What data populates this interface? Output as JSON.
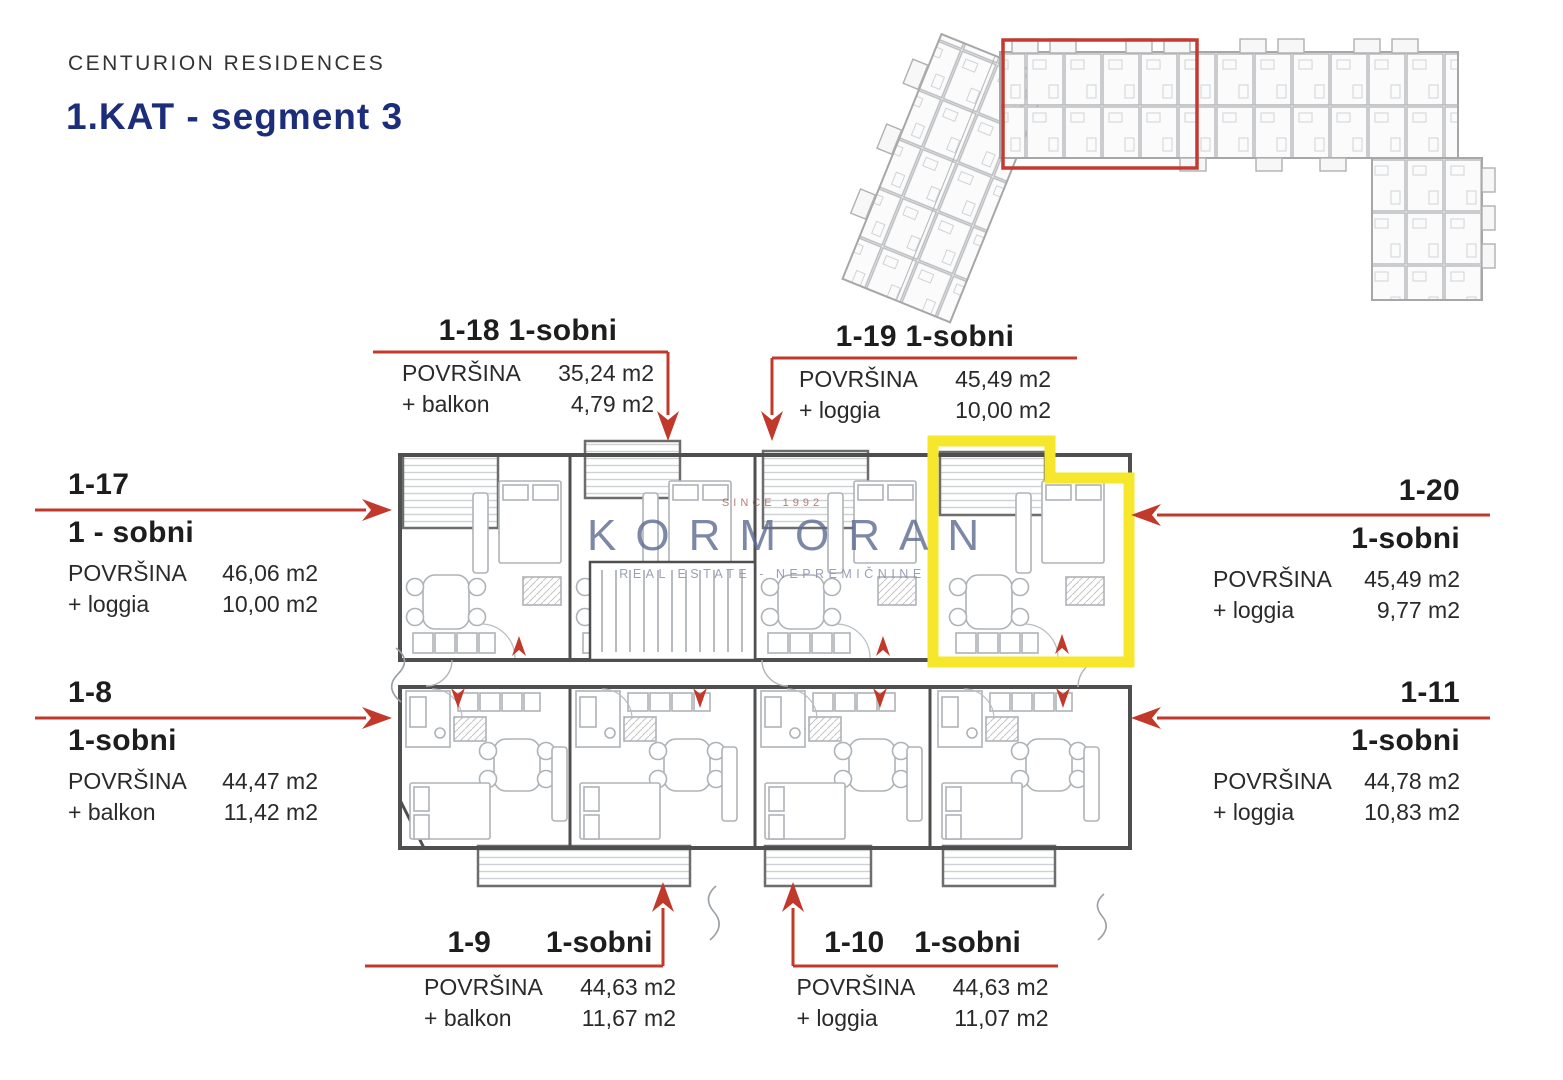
{
  "header": {
    "brand": "CENTURION RESIDENCES",
    "title": "1.KAT - segment 3"
  },
  "watermark": {
    "since": "SINCE 1992",
    "name": "KORMORAN",
    "subtitle": "REAL ESTATE - NEPREMIČNINE"
  },
  "units": [
    {
      "id": "1-18",
      "type": "1-sobni",
      "area_label": "POVRŠINA",
      "area_value": "35,24 m2",
      "extra_label": "+ balkon",
      "extra_value": "4,79 m2"
    },
    {
      "id": "1-19",
      "type": "1-sobni",
      "area_label": "POVRŠINA",
      "area_value": "45,49 m2",
      "extra_label": "+ loggia",
      "extra_value": "10,00 m2"
    },
    {
      "id": "1-17",
      "type": "1 - sobni",
      "area_label": "POVRŠINA",
      "area_value": "46,06 m2",
      "extra_label": "+ loggia",
      "extra_value": "10,00 m2"
    },
    {
      "id": "1-20",
      "type": "1-sobni",
      "area_label": "POVRŠINA",
      "area_value": "45,49 m2",
      "extra_label": "+ loggia",
      "extra_value": "9,77 m2"
    },
    {
      "id": "1-8",
      "type": "1-sobni",
      "area_label": "POVRŠINA",
      "area_value": "44,47 m2",
      "extra_label": "+ balkon",
      "extra_value": "11,42 m2"
    },
    {
      "id": "1-11",
      "type": "1-sobni",
      "area_label": "POVRŠINA",
      "area_value": "44,78 m2",
      "extra_label": "+ loggia",
      "extra_value": "10,83 m2"
    },
    {
      "id": "1-9",
      "type": "1-sobni",
      "area_label": "POVRŠINA",
      "area_value": "44,63 m2",
      "extra_label": "+ balkon",
      "extra_value": "11,67 m2"
    },
    {
      "id": "1-10",
      "type": "1-sobni",
      "area_label": "POVRŠINA",
      "area_value": "44,63 m2",
      "extra_label": "+ loggia",
      "extra_value": "11,07 m2"
    }
  ],
  "colors": {
    "accent_red": "#c0392b",
    "highlight_yellow": "#f6e72c",
    "title_navy": "#1c2d7a",
    "wall_gray": "#4f4f4f",
    "watermark_blue": "#5d6b92"
  }
}
